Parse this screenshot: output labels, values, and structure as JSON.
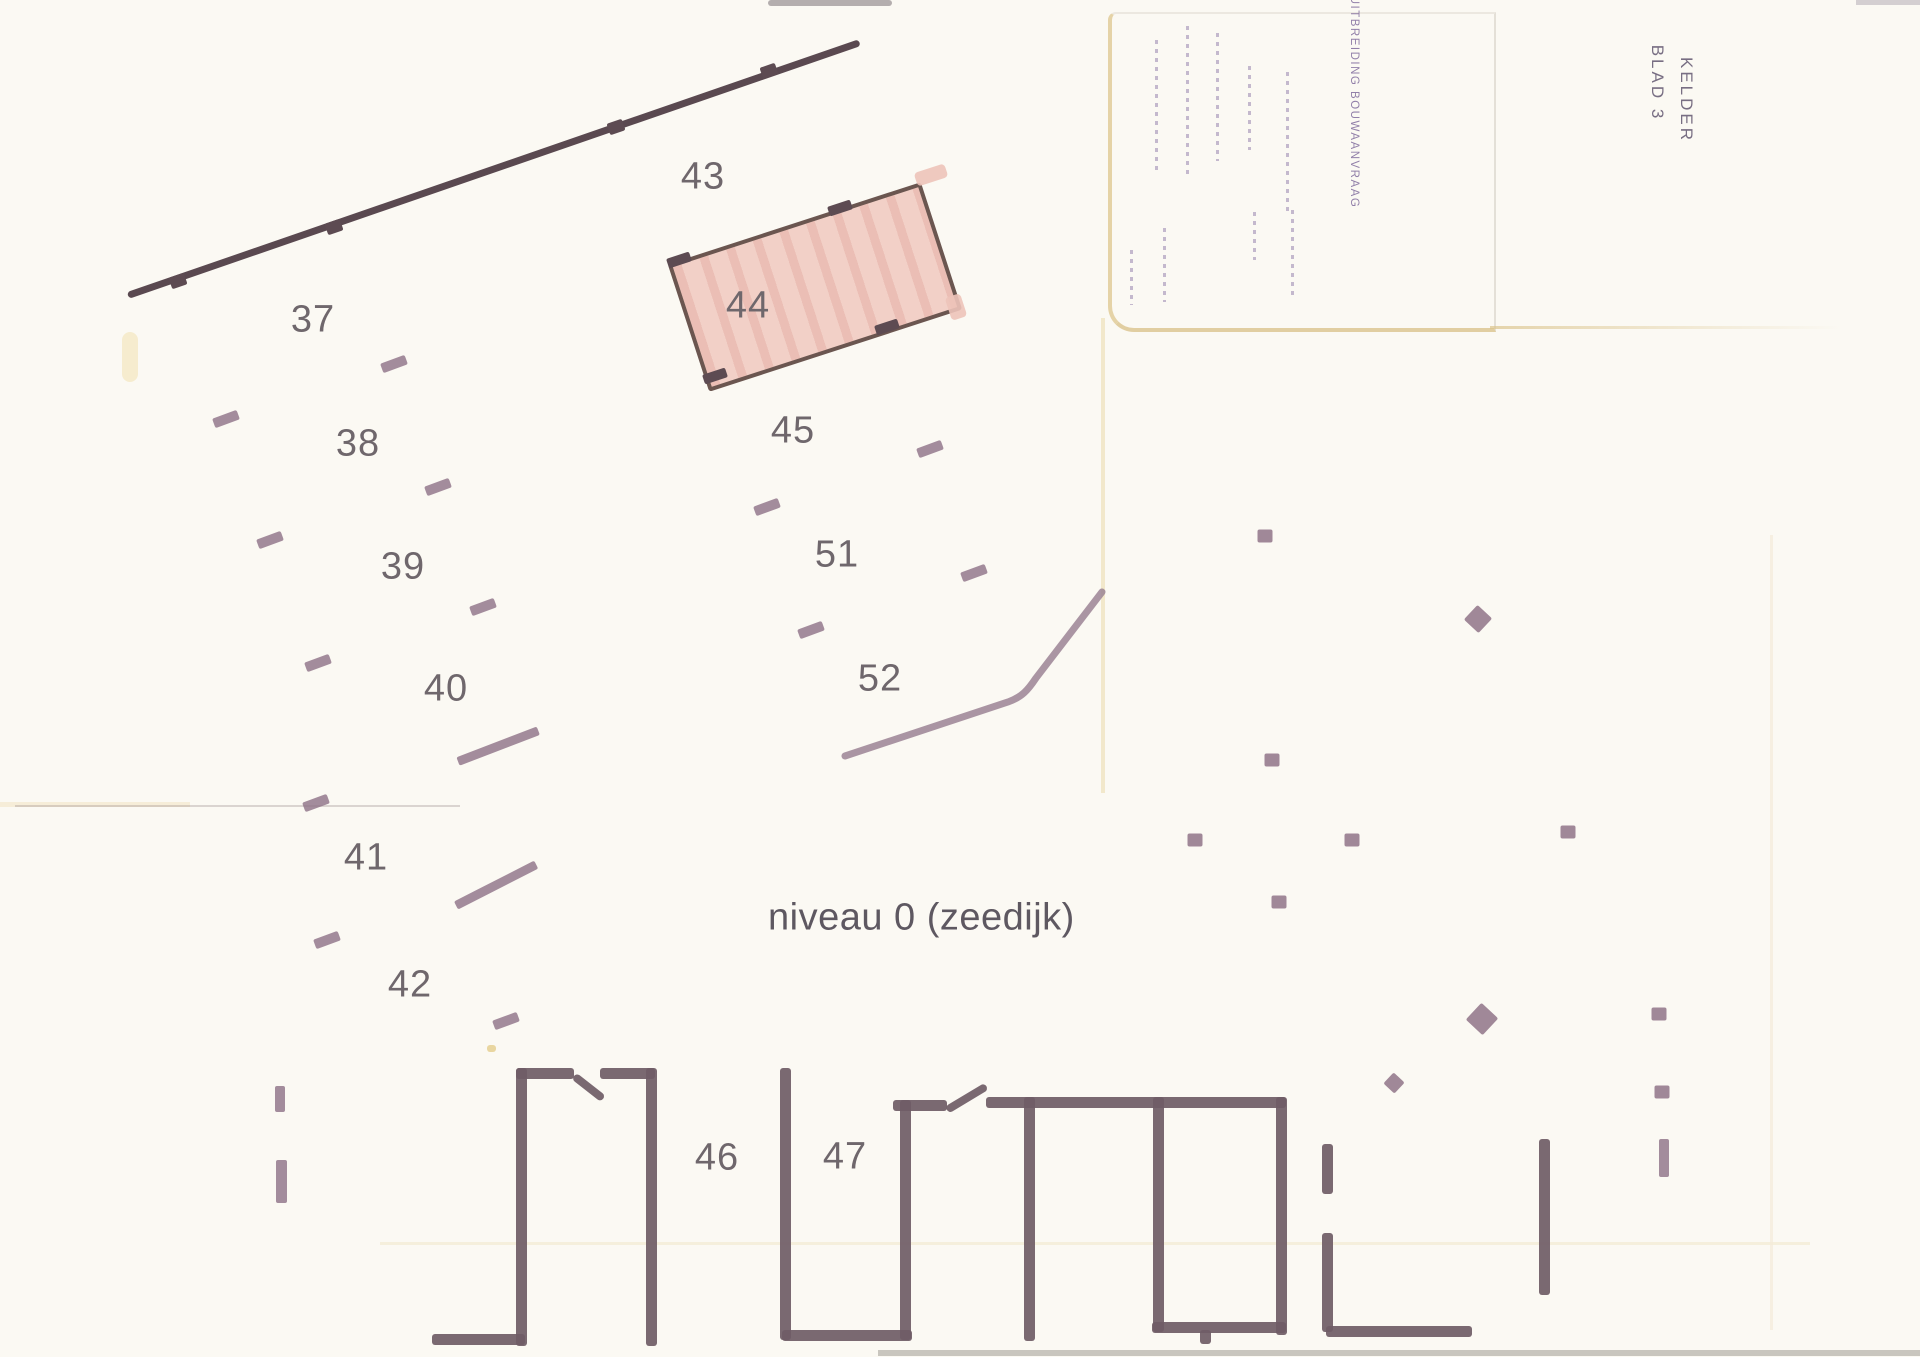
{
  "caption": {
    "text": "niveau 0 (zeedijk)"
  },
  "stamps": {
    "sheet_line1": "BLAD 3",
    "sheet_line2": "KELDER",
    "application": "UITBREIDING BOUWAANVRAAG"
  },
  "colors": {
    "paper": "#fbf9f3",
    "garage_wall": "#6f5c66",
    "boundary_wall": "#5a4950",
    "pillar_mark": "#8d7186",
    "number_text": "#6f676c",
    "highlight_fill": "#f2d0c7",
    "highlight_border": "#6b5650",
    "stamp_purple": "#6a508c",
    "crease_tan": "#e0ca94"
  },
  "plan": {
    "unit_labels": [
      {
        "text": "37",
        "x": 313,
        "y": 320
      },
      {
        "text": "38",
        "x": 358,
        "y": 444
      },
      {
        "text": "39",
        "x": 403,
        "y": 567
      },
      {
        "text": "40",
        "x": 446,
        "y": 689
      },
      {
        "text": "41",
        "x": 366,
        "y": 858
      },
      {
        "text": "42",
        "x": 410,
        "y": 985
      },
      {
        "text": "43",
        "x": 703,
        "y": 177
      },
      {
        "text": "44",
        "x": 748,
        "y": 306
      },
      {
        "text": "45",
        "x": 793,
        "y": 431
      },
      {
        "text": "46",
        "x": 717,
        "y": 1158
      },
      {
        "text": "47",
        "x": 845,
        "y": 1157
      },
      {
        "text": "51",
        "x": 837,
        "y": 555
      },
      {
        "text": "52",
        "x": 880,
        "y": 679
      }
    ],
    "boundary_wall": {
      "x1": 128,
      "y1": 295,
      "x2": 860,
      "y2": 42,
      "nubs": [
        [
          178,
          281
        ],
        [
          334,
          227
        ],
        [
          616,
          127
        ],
        [
          769,
          71
        ]
      ]
    },
    "walls_h": [
      [
        432,
        1334,
        93
      ],
      [
        516,
        1068,
        58
      ],
      [
        600,
        1068,
        55
      ],
      [
        893,
        1100,
        54
      ],
      [
        986,
        1097,
        300
      ],
      [
        782,
        1330,
        130
      ],
      [
        1152,
        1322,
        134
      ],
      [
        1326,
        1326,
        146
      ]
    ],
    "walls_v": [
      [
        516,
        1068,
        278
      ],
      [
        646,
        1068,
        278
      ],
      [
        780,
        1068,
        272
      ],
      [
        900,
        1100,
        240
      ],
      [
        1024,
        1097,
        244
      ],
      [
        1153,
        1097,
        235
      ],
      [
        1276,
        1097,
        238
      ],
      [
        1322,
        1233,
        99
      ],
      [
        1322,
        1144,
        50
      ],
      [
        1539,
        1139,
        156
      ],
      [
        1200,
        1330,
        14
      ]
    ],
    "door_leaves": [
      [
        574,
        1076,
        37,
        38
      ],
      [
        947,
        1110,
        46,
        -31
      ]
    ],
    "bent_wall_path": "M845,756 L1008,702 C1022,697 1028,690 1036,678 L1102,592",
    "ticks": [
      [
        394,
        364
      ],
      [
        226,
        419
      ],
      [
        438,
        487
      ],
      [
        270,
        540
      ],
      [
        483,
        607
      ],
      [
        318,
        663
      ],
      [
        316,
        803
      ],
      [
        327,
        940
      ],
      [
        506,
        1021
      ],
      [
        930,
        449
      ],
      [
        767,
        507
      ],
      [
        974,
        573
      ],
      [
        811,
        630
      ]
    ],
    "long_ticks": [
      [
        458,
        762,
        86,
        -21
      ],
      [
        456,
        906,
        90,
        -27
      ]
    ],
    "v_ticks": [
      [
        275,
        1086,
        10,
        26
      ],
      [
        276,
        1160,
        11,
        43
      ],
      [
        1659,
        1139,
        10,
        38
      ]
    ],
    "dots": [
      [
        1265,
        536
      ],
      [
        1272,
        760
      ],
      [
        1195,
        840
      ],
      [
        1352,
        840
      ],
      [
        1568,
        832
      ],
      [
        1279,
        902
      ],
      [
        1659,
        1014
      ],
      [
        1662,
        1092
      ]
    ],
    "diamonds": [
      [
        1478,
        619,
        20
      ],
      [
        1482,
        1019,
        23
      ],
      [
        1394,
        1083,
        15
      ]
    ],
    "room_border_ticks": [
      [
        840,
        208
      ],
      [
        887,
        327
      ],
      [
        679,
        260
      ],
      [
        715,
        376
      ]
    ],
    "room_overflow": [
      [
        915,
        168,
        32,
        14
      ],
      [
        948,
        295,
        16,
        24
      ]
    ],
    "stamp_columns": [
      [
        1155,
        40,
        135
      ],
      [
        1186,
        26,
        150
      ],
      [
        1216,
        33,
        128
      ],
      [
        1248,
        66,
        84
      ],
      [
        1286,
        72,
        143
      ],
      [
        1130,
        250,
        55
      ],
      [
        1163,
        228,
        74
      ],
      [
        1253,
        212,
        48
      ],
      [
        1291,
        210,
        90
      ]
    ]
  }
}
